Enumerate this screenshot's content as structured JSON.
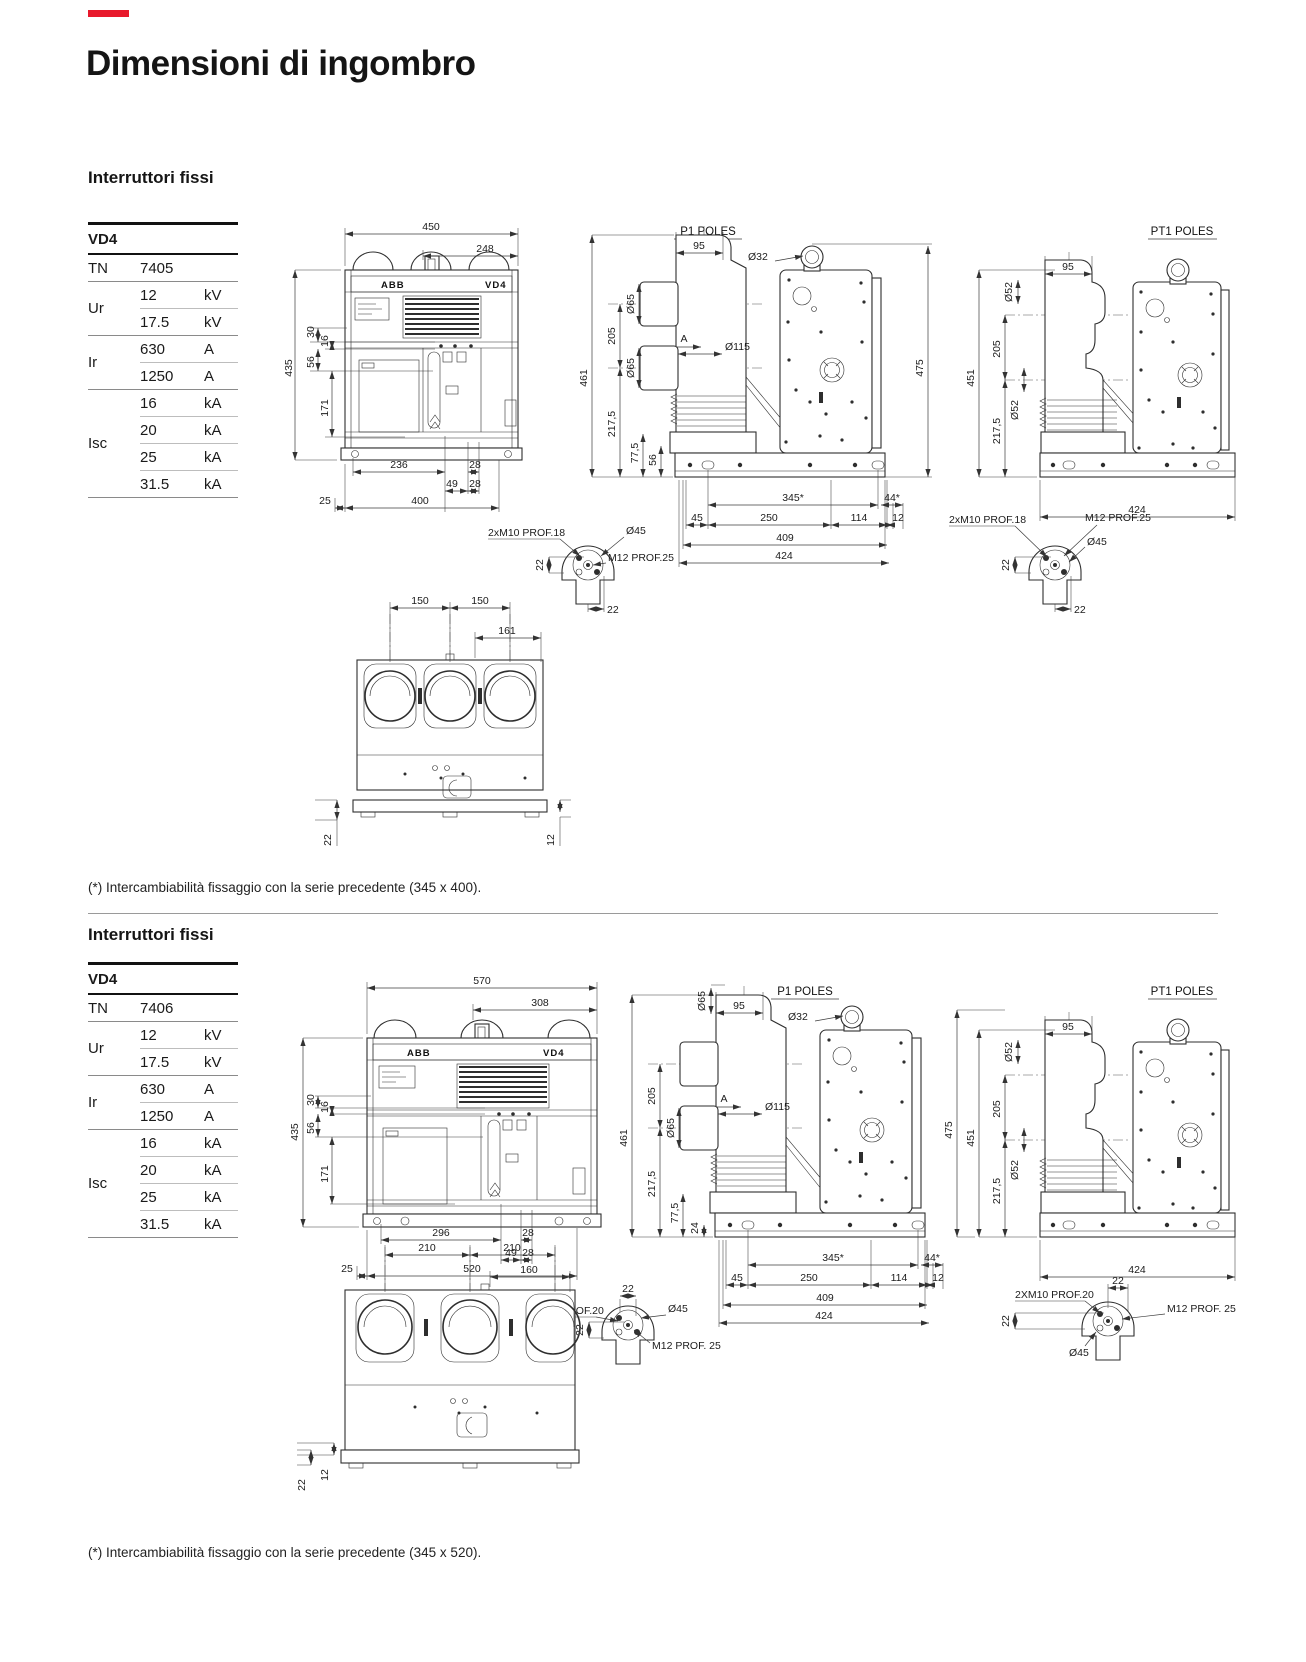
{
  "page": {
    "title": "Dimensioni di ingombro",
    "accent_red": "#e8192c"
  },
  "s1": {
    "heading": "Interruttori fissi",
    "table": {
      "product": "VD4",
      "tn": {
        "label": "TN",
        "value": "7405"
      },
      "ur": {
        "label": "Ur",
        "rows": [
          [
            "12",
            "kV"
          ],
          [
            "17.5",
            "kV"
          ]
        ]
      },
      "ir": {
        "label": "Ir",
        "rows": [
          [
            "630",
            "A"
          ],
          [
            "1250",
            "A"
          ]
        ]
      },
      "isc": {
        "label": "Isc",
        "rows": [
          [
            "16",
            "kA"
          ],
          [
            "20",
            "kA"
          ],
          [
            "25",
            "kA"
          ],
          [
            "31.5",
            "kA"
          ]
        ]
      }
    },
    "front": {
      "brand": "ABB",
      "model": "VD4",
      "w": "450",
      "w_in": "248",
      "h": "435",
      "d30": "30",
      "d16": "16",
      "d56": "56",
      "d171": "171",
      "b236": "236",
      "b28a": "28",
      "b49": "49",
      "b28b": "28",
      "b25": "25",
      "b400": "400"
    },
    "p1": {
      "title": "P1 POLES",
      "d95": "95",
      "d32": "Ø32",
      "d65a": "Ø65",
      "d65b": "Ø65",
      "d115": "Ø115",
      "d205": "205",
      "d461": "461",
      "d2175": "217,5",
      "d775": "77,5",
      "d56": "56",
      "a": "A",
      "d475": "475",
      "d345": "345*",
      "d45": "45",
      "d250": "250",
      "d114": "114",
      "d44": "44*",
      "d12": "12",
      "d409": "409",
      "d424": "424"
    },
    "pt1": {
      "title": "PT1 POLES",
      "d95": "95",
      "d52a": "Ø52",
      "d52b": "Ø52",
      "d451": "451",
      "d205": "205",
      "d2175": "217,5",
      "d424": "424"
    },
    "det1": {
      "m10": "2xM10 PROF.18",
      "m12": "M12 PROF.25",
      "d45": "Ø45",
      "d22a": "22",
      "d22b": "22"
    },
    "det2": {
      "m10": "2xM10 PROF.18",
      "m12": "M12 PROF.25",
      "d45": "Ø45",
      "d22a": "22",
      "d22b": "22"
    },
    "bottom": {
      "d150a": "150",
      "d150b": "150",
      "d161": "161",
      "d22": "22",
      "d12": "12"
    },
    "footnote": "(*) Intercambiabilità fissaggio con la serie precedente (345 x 400)."
  },
  "s2": {
    "heading": "Interruttori fissi",
    "table": {
      "product": "VD4",
      "tn": {
        "label": "TN",
        "value": "7406"
      },
      "ur": {
        "label": "Ur",
        "rows": [
          [
            "12",
            "kV"
          ],
          [
            "17.5",
            "kV"
          ]
        ]
      },
      "ir": {
        "label": "Ir",
        "rows": [
          [
            "630",
            "A"
          ],
          [
            "1250",
            "A"
          ]
        ]
      },
      "isc": {
        "label": "Isc",
        "rows": [
          [
            "16",
            "kA"
          ],
          [
            "20",
            "kA"
          ],
          [
            "25",
            "kA"
          ],
          [
            "31.5",
            "kA"
          ]
        ]
      }
    },
    "front": {
      "brand": "ABB",
      "model": "VD4",
      "w": "570",
      "w_in": "308",
      "h": "435",
      "d30": "30",
      "d16": "16",
      "d56": "56",
      "d171": "171",
      "b296": "296",
      "b28a": "28",
      "b49": "49",
      "b28b": "28",
      "b25": "25",
      "b520": "520"
    },
    "p1": {
      "title": "P1 POLES",
      "d65t": "Ø65",
      "d95": "95",
      "d32": "Ø32",
      "d65b": "Ø65",
      "d115": "Ø115",
      "d205": "205",
      "d461": "461",
      "d2175": "217,5",
      "d775": "77,5",
      "d24": "24",
      "a": "A",
      "d345": "345*",
      "d45": "45",
      "d250": "250",
      "d114": "114",
      "d44": "44*",
      "d12": "12",
      "d409": "409",
      "d424": "424"
    },
    "pt1": {
      "title": "PT1 POLES",
      "d95": "95",
      "d52a": "Ø52",
      "d52b": "Ø52",
      "d475": "475",
      "d451": "451",
      "d205": "205",
      "d2175": "217,5",
      "d424": "424"
    },
    "det3": {
      "m10": "2XM10 PROF.20",
      "m12": "M12 PROF. 25",
      "d45": "Ø45",
      "d22a": "22",
      "d22b": "22"
    },
    "det4": {
      "m10": "2XM10 PROF.20",
      "m12": "M12 PROF. 25",
      "d45": "Ø45",
      "d22a": "22",
      "d22b": "22"
    },
    "bottom": {
      "d210a": "210",
      "d210b": "210",
      "d160": "160",
      "d22": "22",
      "d12": "12"
    },
    "footnote": "(*) Intercambiabilità fissaggio con la serie precedente (345 x 520)."
  }
}
